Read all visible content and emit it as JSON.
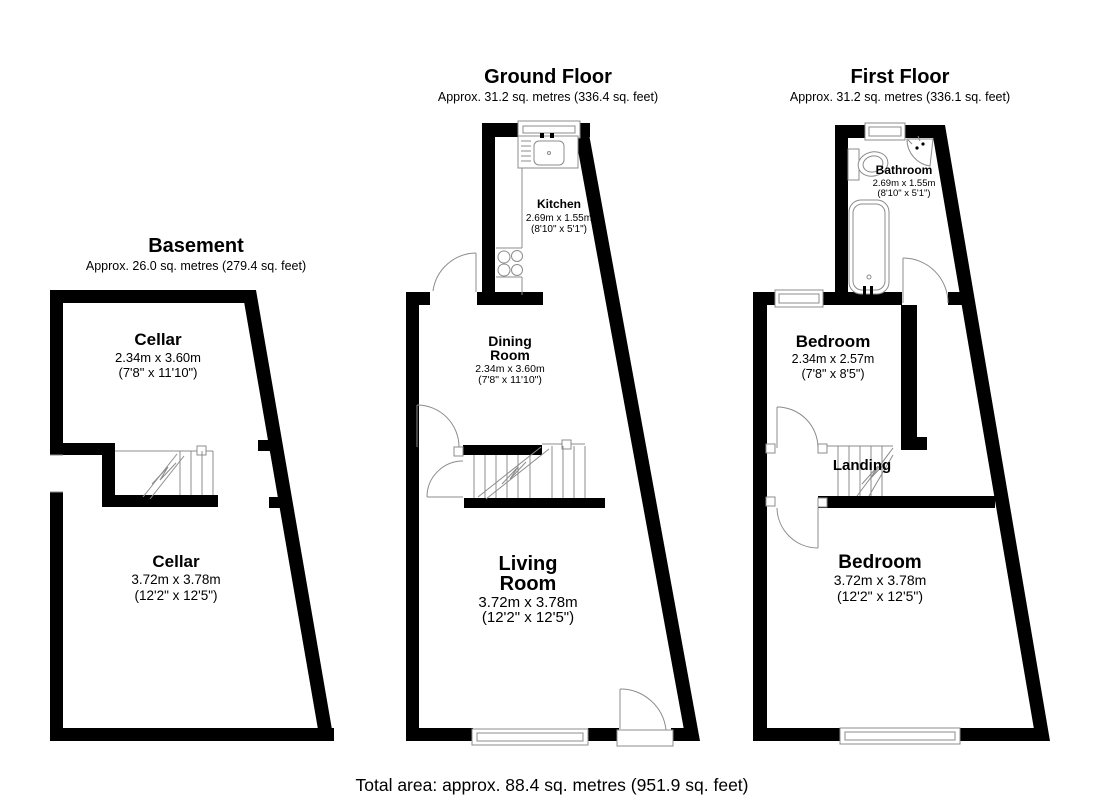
{
  "colors": {
    "wall": "#000000",
    "line": "#8c8c8c",
    "text": "#000000",
    "background": "#ffffff"
  },
  "footer": {
    "total_area": "Total area: approx. 88.4 sq. metres (951.9 sq. feet)"
  },
  "floors": [
    {
      "id": "basement",
      "title": "Basement",
      "area": "Approx. 26.0 sq. metres (279.4 sq. feet)",
      "rooms": [
        {
          "name": "Cellar",
          "dims_m": "2.34m x 3.60m",
          "dims_ft": "(7'8\" x 11'10\")"
        },
        {
          "name": "Cellar",
          "dims_m": "3.72m x 3.78m",
          "dims_ft": "(12'2\" x 12'5\")"
        }
      ]
    },
    {
      "id": "ground-floor",
      "title": "Ground Floor",
      "area": "Approx. 31.2 sq. metres (336.4 sq. feet)",
      "rooms": [
        {
          "name": "Kitchen",
          "dims_m": "2.69m x 1.55m",
          "dims_ft": "(8'10\" x 5'1\")"
        },
        {
          "name": "Dining Room",
          "name1": "Dining",
          "name2": "Room",
          "dims_m": "2.34m x 3.60m",
          "dims_ft": "(7'8\" x 11'10\")"
        },
        {
          "name": "Living Room",
          "name1": "Living",
          "name2": "Room",
          "dims_m": "3.72m x 3.78m",
          "dims_ft": "(12'2\" x 12'5\")"
        }
      ]
    },
    {
      "id": "first-floor",
      "title": "First Floor",
      "area": "Approx. 31.2 sq. metres (336.1 sq. feet)",
      "rooms": [
        {
          "name": "Bathroom",
          "dims_m": "2.69m x 1.55m",
          "dims_ft": "(8'10\" x 5'1\")"
        },
        {
          "name": "Bedroom",
          "dims_m": "2.34m x 2.57m",
          "dims_ft": "(7'8\" x 8'5\")"
        },
        {
          "name": "Landing"
        },
        {
          "name": "Bedroom",
          "dims_m": "3.72m x 3.78m",
          "dims_ft": "(12'2\" x 12'5\")"
        }
      ]
    }
  ]
}
